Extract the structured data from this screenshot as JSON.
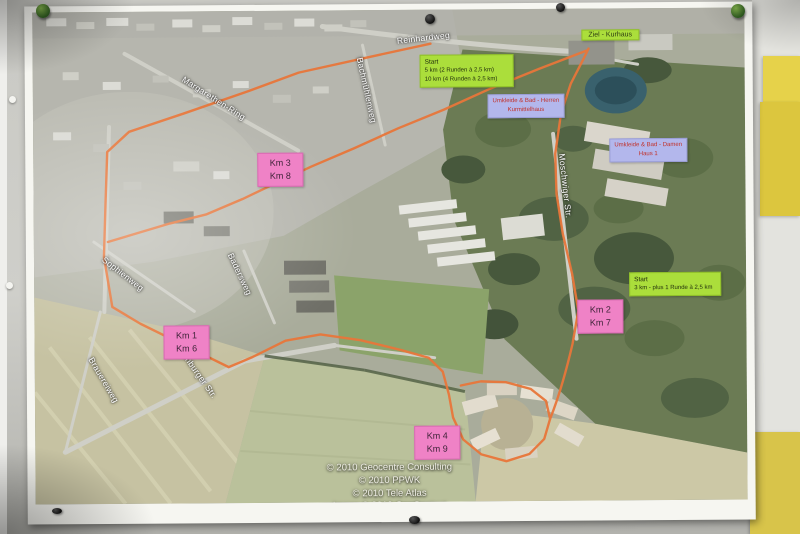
{
  "map": {
    "street_labels": [
      {
        "text": "Reinhardweg"
      },
      {
        "text": "Margarethen-Ring"
      },
      {
        "text": "Bachmühlenweg"
      },
      {
        "text": "Sophienweg"
      },
      {
        "text": "Badersweg"
      },
      {
        "text": "Brauereiweg"
      },
      {
        "text": "Eilenburger Str."
      },
      {
        "text": "Moschwiger Str."
      }
    ],
    "km_markers": [
      {
        "line1": "Km 3",
        "line2": "Km 8"
      },
      {
        "line1": "Km 1",
        "line2": "Km 6"
      },
      {
        "line1": "Km 2",
        "line2": "Km 7"
      },
      {
        "line1": "Km 4",
        "line2": "Km 9"
      }
    ],
    "start_boxes": [
      {
        "title": "Start",
        "line1": "5 km (2 Runden à 2,5 km)",
        "line2": "10 km (4 Runden à 2,5 km)"
      },
      {
        "title": "Start",
        "line1": "3 km - plus 1 Runde à 2,5 km"
      }
    ],
    "finish_label": {
      "text": "Ziel - Kurhaus"
    },
    "facility_labels": [
      {
        "line1": "Umkleide & Bad - Herren",
        "line2": "Kurmittelhaus"
      },
      {
        "line1": "Umkleide & Bad - Damen",
        "line2": "Haus 1"
      }
    ],
    "copyright": [
      "© 2010 Geocentre Consulting",
      "© 2010 PPWK",
      "© 2010 Tele Atlas",
      "Image © 2010 GeoContent"
    ]
  },
  "colors": {
    "route": "#e8763a",
    "km_box": "#ef82c6",
    "start_box": "#abde3b",
    "facility_box": "#b3b7ec",
    "facility_text": "#c13129"
  }
}
